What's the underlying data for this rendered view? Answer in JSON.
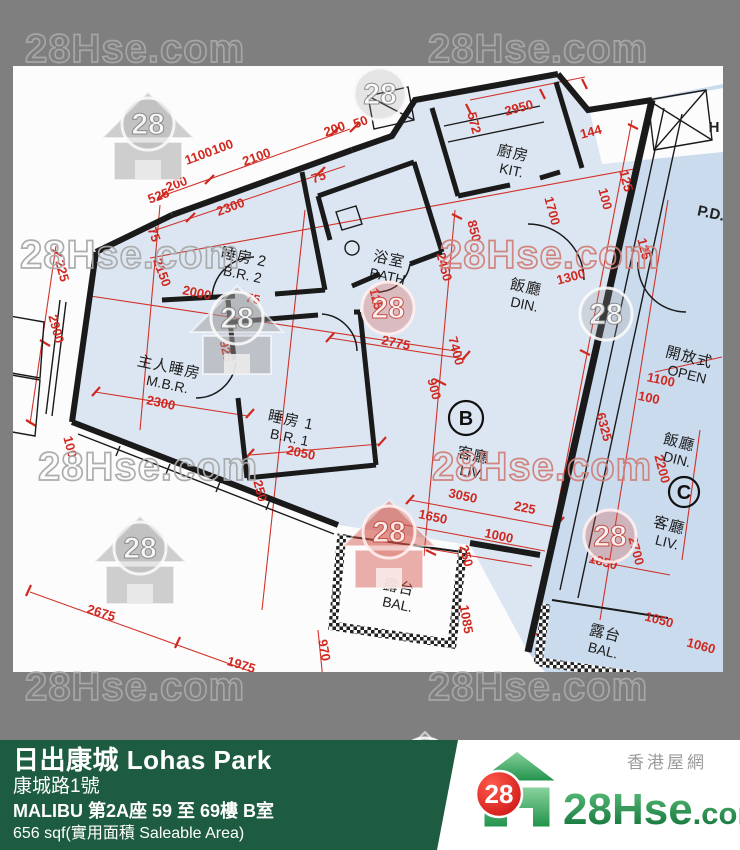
{
  "banner": {
    "estate": "日出康城 Lohas Park",
    "address": "康城路1號",
    "building": "MALIBU 第2A座 59 至 69樓 B室",
    "area": "656 sqf(實用面積 Saleable Area)"
  },
  "logo": {
    "tagline": "香港屋網",
    "brand": "28Hse",
    "brand_suffix": ".com",
    "badge": "28"
  },
  "colors": {
    "background_gray": "#7f7f7f",
    "banner_green": "#1d5c40",
    "dimension_red": "#d0281e",
    "wall_black": "#1a1a1a",
    "room_fill": "#dce6f2",
    "unit_c_fill": "#cbdbee",
    "logo_green_dark": "#0b6b33",
    "logo_green_light": "#5fc47e",
    "badge_red": "#e41818"
  },
  "watermarks": {
    "label": "28Hse.com",
    "badge": "28",
    "text_items": [
      {
        "x": 25,
        "y": 62,
        "variant": "gray"
      },
      {
        "x": 428,
        "y": 62,
        "variant": "gray"
      },
      {
        "x": 20,
        "y": 268,
        "variant": "gray"
      },
      {
        "x": 440,
        "y": 268,
        "variant": "red"
      },
      {
        "x": 38,
        "y": 480,
        "variant": "gray"
      },
      {
        "x": 432,
        "y": 480,
        "variant": "red"
      },
      {
        "x": 25,
        "y": 700,
        "variant": "gray"
      },
      {
        "x": 428,
        "y": 700,
        "variant": "gray"
      }
    ],
    "logo_items": [
      {
        "x": 148,
        "y": 128,
        "variant": "gray",
        "house": true
      },
      {
        "x": 380,
        "y": 98,
        "variant": "gray",
        "house": false
      },
      {
        "x": 237,
        "y": 322,
        "variant": "gray",
        "house": true
      },
      {
        "x": 388,
        "y": 312,
        "variant": "red",
        "house": false
      },
      {
        "x": 606,
        "y": 318,
        "variant": "gray",
        "house": false
      },
      {
        "x": 389,
        "y": 536,
        "variant": "red",
        "house": true
      },
      {
        "x": 610,
        "y": 540,
        "variant": "red",
        "house": false
      },
      {
        "x": 140,
        "y": 552,
        "variant": "gray",
        "house": true
      },
      {
        "x": 425,
        "y": 768,
        "variant": "gray",
        "house": true
      }
    ]
  },
  "plan": {
    "unit_circles": [
      {
        "letter": "B",
        "x": 466,
        "y": 418,
        "r": 17
      },
      {
        "letter": "C",
        "x": 684,
        "y": 492,
        "r": 15
      }
    ],
    "rooms": [
      {
        "zh": "睡房 2",
        "en": "B.R. 2",
        "x": 243,
        "y": 262,
        "a": 12
      },
      {
        "zh": "浴室",
        "en": "BATH",
        "x": 388,
        "y": 264,
        "a": 12
      },
      {
        "zh": "廚房",
        "en": "KIT.",
        "x": 512,
        "y": 158,
        "a": 12
      },
      {
        "zh": "飯廳",
        "en": "DIN.",
        "x": 525,
        "y": 292,
        "a": 12
      },
      {
        "zh": "主人睡房",
        "en": "M.B.R.",
        "x": 168,
        "y": 372,
        "a": 12
      },
      {
        "zh": "睡房 1",
        "en": "B.R. 1",
        "x": 290,
        "y": 425,
        "a": 12
      },
      {
        "zh": "客廳",
        "en": "LIV.",
        "x": 472,
        "y": 460,
        "a": 12
      },
      {
        "zh": "露台",
        "en": "BAL.",
        "x": 398,
        "y": 592,
        "a": 12
      },
      {
        "zh": "開放式",
        "en": "OPEN",
        "x": 688,
        "y": 362,
        "a": 14
      },
      {
        "zh": "飯廳",
        "en": "DIN.",
        "x": 678,
        "y": 447,
        "a": 14
      },
      {
        "zh": "客廳",
        "en": "LIV.",
        "x": 668,
        "y": 530,
        "a": 14
      },
      {
        "zh": "露台",
        "en": "BAL.",
        "x": 604,
        "y": 638,
        "a": 14
      }
    ],
    "side_labels": [
      {
        "t": "H",
        "x": 714,
        "y": 132,
        "a": 0
      },
      {
        "t": "P.D.",
        "x": 710,
        "y": 218,
        "a": 12
      }
    ],
    "dims": [
      {
        "t": "200",
        "x": 178,
        "y": 188,
        "a": -20
      },
      {
        "t": "2100",
        "x": 258,
        "y": 161,
        "a": -20
      },
      {
        "t": "200",
        "x": 336,
        "y": 133,
        "a": -20
      },
      {
        "t": "50",
        "x": 362,
        "y": 126,
        "a": -20
      },
      {
        "t": "2300",
        "x": 232,
        "y": 211,
        "a": -20
      },
      {
        "t": "75",
        "x": 320,
        "y": 181,
        "a": -20
      },
      {
        "t": "1100",
        "x": 200,
        "y": 160,
        "a": -20
      },
      {
        "t": "100",
        "x": 224,
        "y": 151,
        "a": -20
      },
      {
        "t": "525",
        "x": 160,
        "y": 200,
        "a": -20
      },
      {
        "t": "75",
        "x": 150,
        "y": 236,
        "a": 70
      },
      {
        "t": "2150",
        "x": 158,
        "y": 274,
        "a": 70
      },
      {
        "t": "2000",
        "x": 196,
        "y": 297,
        "a": 12
      },
      {
        "t": "75",
        "x": 252,
        "y": 303,
        "a": 12
      },
      {
        "t": "2775",
        "x": 395,
        "y": 347,
        "a": 12
      },
      {
        "t": "925",
        "x": 222,
        "y": 352,
        "a": 75
      },
      {
        "t": "900",
        "x": 430,
        "y": 390,
        "a": 75
      },
      {
        "t": "2300",
        "x": 160,
        "y": 407,
        "a": 12
      },
      {
        "t": "2900",
        "x": 52,
        "y": 330,
        "a": 75
      },
      {
        "t": "225",
        "x": 58,
        "y": 272,
        "a": 75
      },
      {
        "t": "100",
        "x": 66,
        "y": 448,
        "a": 75
      },
      {
        "t": "2050",
        "x": 300,
        "y": 457,
        "a": 12
      },
      {
        "t": "250",
        "x": 256,
        "y": 492,
        "a": 75
      },
      {
        "t": "125",
        "x": 372,
        "y": 300,
        "a": 75
      },
      {
        "t": "2950",
        "x": 520,
        "y": 112,
        "a": -15
      },
      {
        "t": "572",
        "x": 470,
        "y": 124,
        "a": 75
      },
      {
        "t": "144",
        "x": 592,
        "y": 136,
        "a": -15
      },
      {
        "t": "125",
        "x": 622,
        "y": 182,
        "a": 75
      },
      {
        "t": "100",
        "x": 601,
        "y": 200,
        "a": 75
      },
      {
        "t": "850",
        "x": 470,
        "y": 232,
        "a": 75
      },
      {
        "t": "1700",
        "x": 548,
        "y": 212,
        "a": 75
      },
      {
        "t": "2450",
        "x": 440,
        "y": 268,
        "a": 75
      },
      {
        "t": "1300",
        "x": 572,
        "y": 281,
        "a": -15
      },
      {
        "t": "7400",
        "x": 452,
        "y": 352,
        "a": 75
      },
      {
        "t": "6325",
        "x": 600,
        "y": 428,
        "a": 75
      },
      {
        "t": "3050",
        "x": 462,
        "y": 500,
        "a": 12
      },
      {
        "t": "1650",
        "x": 432,
        "y": 521,
        "a": 12
      },
      {
        "t": "225",
        "x": 524,
        "y": 512,
        "a": 12
      },
      {
        "t": "1000",
        "x": 498,
        "y": 540,
        "a": 12
      },
      {
        "t": "250",
        "x": 462,
        "y": 557,
        "a": 75
      },
      {
        "t": "2675",
        "x": 100,
        "y": 617,
        "a": 17
      },
      {
        "t": "1975",
        "x": 240,
        "y": 669,
        "a": 17
      },
      {
        "t": "970",
        "x": 320,
        "y": 651,
        "a": 80
      },
      {
        "t": "200",
        "x": 290,
        "y": 687,
        "a": 17
      },
      {
        "t": "1100",
        "x": 660,
        "y": 384,
        "a": 12
      },
      {
        "t": "100",
        "x": 648,
        "y": 402,
        "a": 12
      },
      {
        "t": "125",
        "x": 640,
        "y": 250,
        "a": 75
      },
      {
        "t": "2200",
        "x": 658,
        "y": 470,
        "a": 75
      },
      {
        "t": "2700",
        "x": 632,
        "y": 552,
        "a": 75
      },
      {
        "t": "1850",
        "x": 602,
        "y": 566,
        "a": 15
      },
      {
        "t": "1050",
        "x": 658,
        "y": 624,
        "a": 15
      },
      {
        "t": "1085",
        "x": 462,
        "y": 620,
        "a": 80
      },
      {
        "t": "1060",
        "x": 700,
        "y": 650,
        "a": 15
      }
    ]
  }
}
